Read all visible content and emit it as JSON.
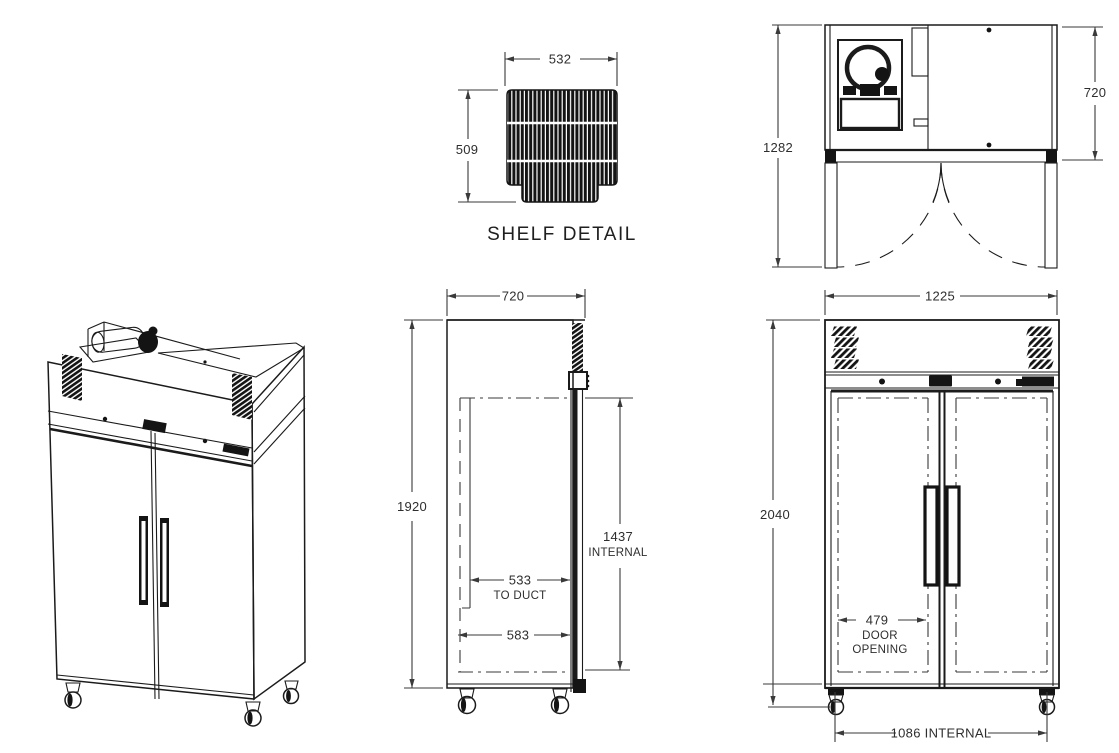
{
  "drawing": {
    "background_color": "#ffffff",
    "line_color": "#1b1b1b",
    "views": {
      "shelf_detail": {
        "label": "SHELF DETAIL",
        "width": "532",
        "depth": "509"
      },
      "plan_view": {
        "overall_depth_doors_open": "1282",
        "body_depth": "720"
      },
      "side_view": {
        "depth": "720",
        "height": "1920",
        "internal_height_value": "1437",
        "internal_height_label": "INTERNAL",
        "duct_value": "533",
        "duct_label": "TO DUCT",
        "base_internal_depth": "583"
      },
      "front_view": {
        "width": "1225",
        "height": "2040",
        "door_opening_value": "479",
        "door_opening_label_1": "DOOR",
        "door_opening_label_2": "OPENING",
        "internal_width": "1086  INTERNAL"
      }
    }
  }
}
